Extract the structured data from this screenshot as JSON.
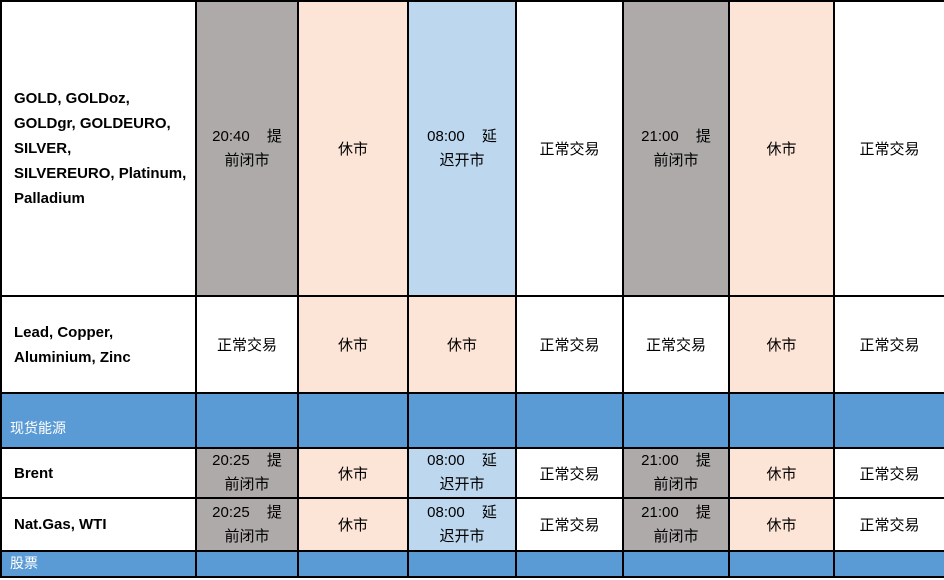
{
  "colors": {
    "early_close_bg": "#AEAAAA",
    "closed_bg": "#FCE4D6",
    "delayed_open_bg": "#BDD7EE",
    "normal_bg": "#FFFFFF",
    "section_bg": "#5B9BD5",
    "border": "#000000",
    "text": "#000000",
    "section_text": "#FFFFFF"
  },
  "table": {
    "col_widths_px": [
      195,
      102,
      110,
      108,
      107,
      106,
      105,
      111
    ],
    "rows": [
      {
        "kind": "data",
        "name": "product-row-precious-metals",
        "height_px": 295,
        "cells": [
          {
            "type": "name",
            "bg": "normal_bg",
            "lines": [
              "GOLD, GOLDoz,",
              "GOLDgr, GOLDEURO,",
              "SILVER,",
              "SILVEREURO, Platinum,",
              "Palladium"
            ]
          },
          {
            "type": "time",
            "bg": "early_close_bg",
            "lines": [
              "20:40 提",
              "前闭市"
            ]
          },
          {
            "type": "status",
            "bg": "closed_bg",
            "text": "休市"
          },
          {
            "type": "time",
            "bg": "delayed_open_bg",
            "lines": [
              "08:00 延",
              "迟开市"
            ]
          },
          {
            "type": "status",
            "bg": "normal_bg",
            "text": "正常交易"
          },
          {
            "type": "time",
            "bg": "early_close_bg",
            "lines": [
              "21:00 提",
              "前闭市"
            ]
          },
          {
            "type": "status",
            "bg": "closed_bg",
            "text": "休市"
          },
          {
            "type": "status",
            "bg": "normal_bg",
            "text": "正常交易"
          }
        ]
      },
      {
        "kind": "data",
        "name": "product-row-base-metals",
        "height_px": 97,
        "cells": [
          {
            "type": "name",
            "bg": "normal_bg",
            "lines": [
              "Lead, Copper,",
              "Aluminium, Zinc"
            ]
          },
          {
            "type": "status",
            "bg": "normal_bg",
            "text": "正常交易"
          },
          {
            "type": "status",
            "bg": "closed_bg",
            "text": "休市"
          },
          {
            "type": "status",
            "bg": "closed_bg",
            "text": "休市"
          },
          {
            "type": "status",
            "bg": "normal_bg",
            "text": "正常交易"
          },
          {
            "type": "status",
            "bg": "normal_bg",
            "text": "正常交易"
          },
          {
            "type": "status",
            "bg": "closed_bg",
            "text": "休市"
          },
          {
            "type": "status",
            "bg": "normal_bg",
            "text": "正常交易"
          }
        ]
      },
      {
        "kind": "section",
        "name": "section-row-spot-energy",
        "height_px": 55,
        "label": "现货能源",
        "short": false
      },
      {
        "kind": "data",
        "name": "product-row-brent",
        "height_px": 48,
        "cells": [
          {
            "type": "name",
            "bg": "normal_bg",
            "lines": [
              "Brent"
            ]
          },
          {
            "type": "time",
            "bg": "early_close_bg",
            "lines": [
              "20:25 提",
              "前闭市"
            ]
          },
          {
            "type": "status",
            "bg": "closed_bg",
            "text": "休市"
          },
          {
            "type": "time",
            "bg": "delayed_open_bg",
            "lines": [
              "08:00 延",
              "迟开市"
            ]
          },
          {
            "type": "status",
            "bg": "normal_bg",
            "text": "正常交易"
          },
          {
            "type": "time",
            "bg": "early_close_bg",
            "lines": [
              "21:00 提",
              "前闭市"
            ]
          },
          {
            "type": "status",
            "bg": "closed_bg",
            "text": "休市"
          },
          {
            "type": "status",
            "bg": "normal_bg",
            "text": "正常交易"
          }
        ]
      },
      {
        "kind": "data",
        "name": "product-row-natgas-wti",
        "height_px": 53,
        "cells": [
          {
            "type": "name",
            "bg": "normal_bg",
            "lines": [
              "Nat.Gas, WTI"
            ]
          },
          {
            "type": "time",
            "bg": "early_close_bg",
            "lines": [
              "20:25 提",
              "前闭市"
            ]
          },
          {
            "type": "status",
            "bg": "closed_bg",
            "text": "休市"
          },
          {
            "type": "time",
            "bg": "delayed_open_bg",
            "lines": [
              "08:00 延",
              "迟开市"
            ]
          },
          {
            "type": "status",
            "bg": "normal_bg",
            "text": "正常交易"
          },
          {
            "type": "time",
            "bg": "early_close_bg",
            "lines": [
              "21:00 提",
              "前闭市"
            ]
          },
          {
            "type": "status",
            "bg": "closed_bg",
            "text": "休市"
          },
          {
            "type": "status",
            "bg": "normal_bg",
            "text": "正常交易"
          }
        ]
      },
      {
        "kind": "section",
        "name": "section-row-stocks",
        "height_px": 26,
        "label": "股票",
        "short": true
      }
    ]
  }
}
